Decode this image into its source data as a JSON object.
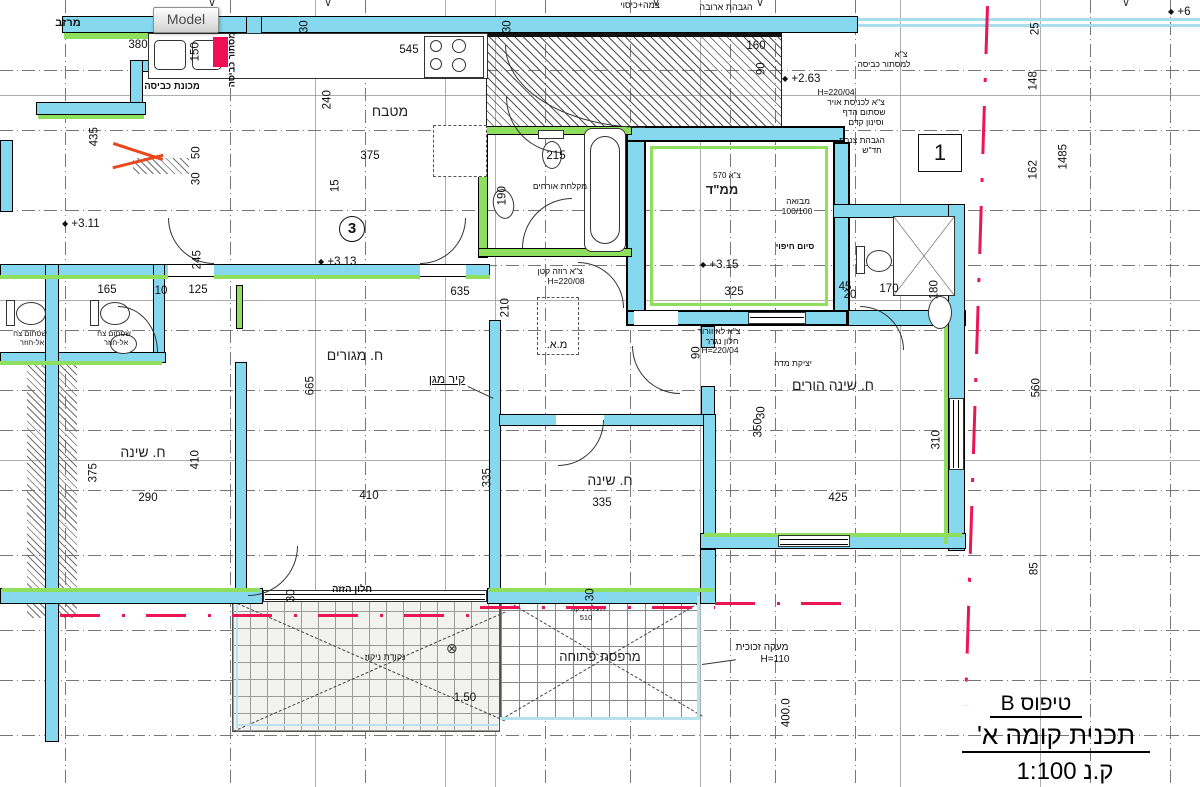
{
  "app": {
    "model_tab": "Model"
  },
  "title_block": {
    "type_label": "טיפוס B",
    "plan_label": "תכנית קומה א'",
    "scale_label": "ק.נ 1:100"
  },
  "markers": {
    "circle_number": "3",
    "detail_number": "1"
  },
  "icons": {
    "elevation_marker": "◆",
    "drain_symbol": "⊗",
    "section_marker": "∨"
  },
  "elevations": [
    "+3.11",
    "+3.13",
    "+3.15",
    "+2.63",
    "+6"
  ],
  "rooms": {
    "kitchen": "מטבח",
    "living": "ח. מגורים",
    "bedroom1": "ח. שינה",
    "bedroom2": "ח. שינה",
    "parents": "ח. שינה הורים",
    "mamad": "ממ\"ד",
    "balcony": "מרפסת פתוחה"
  },
  "annotations": {
    "protective_wall": "קיר מגן",
    "glass_railing": "מעקה זכוכית",
    "glass_railing_h": "H=110",
    "mast_cover": "צמה+כיסוי",
    "chimney": "הגבהת ארובה",
    "laundry_marker": "צ\"א",
    "laundry_line": "למסתור כביסה",
    "air1": "H=220/04",
    "air2": "צ\"א לכניסת אויר",
    "air3": "שסתום הדף",
    "air4": "וסינון קדם",
    "pipes1": "הגבהת צנרת",
    "pipes2": "חד\"ש",
    "lobby": "מבואה",
    "lobby_size": "100/100",
    "cladding": "סיום חיפוי",
    "roza1": "צ\"א רוזה קטן",
    "roza2": "H=220/08",
    "ac_unit": "מ.א.",
    "vent1": "צ\"א לאיוורור",
    "vent2": "חלון נגרר",
    "vent3": "H=220/04",
    "screed": "יציקת מדה",
    "guest_bath": "מקלחת אורחים",
    "valve1": "שסתום צח",
    "valve2": "אל-חוזר",
    "laundry_screen_v": "מסתור כביסה",
    "laundry_machine": "מכונת כביסה",
    "gutter": "מרזב",
    "drain_point": "נקודת ניקוז",
    "drain_channel": "תעלת ניקוז",
    "drain_channel_size": "510",
    "sliding_window": "חלון הזזה",
    "mamad_tag": "צ\"א 570"
  },
  "dims": [
    "380",
    "150",
    "545",
    "30",
    "30",
    "240",
    "435",
    "50",
    "30",
    "375",
    "15",
    "215",
    "190",
    "160",
    "90",
    "25",
    "148",
    "162",
    "1485",
    "245",
    "165",
    "10",
    "125",
    "635",
    "210",
    "325",
    "45",
    "170",
    "180",
    "665",
    "90",
    "350",
    "310",
    "425",
    "560",
    "85",
    "375",
    "410",
    "290",
    "410",
    "335",
    "335",
    "30",
    "30",
    "30",
    "1.50",
    "400.0",
    "20"
  ],
  "colors": {
    "wall_fill": "#85d8ee",
    "insulation_green": "#8fdf5f",
    "boundary_red": "#ed1655",
    "revision_orange": "#e8481c"
  }
}
